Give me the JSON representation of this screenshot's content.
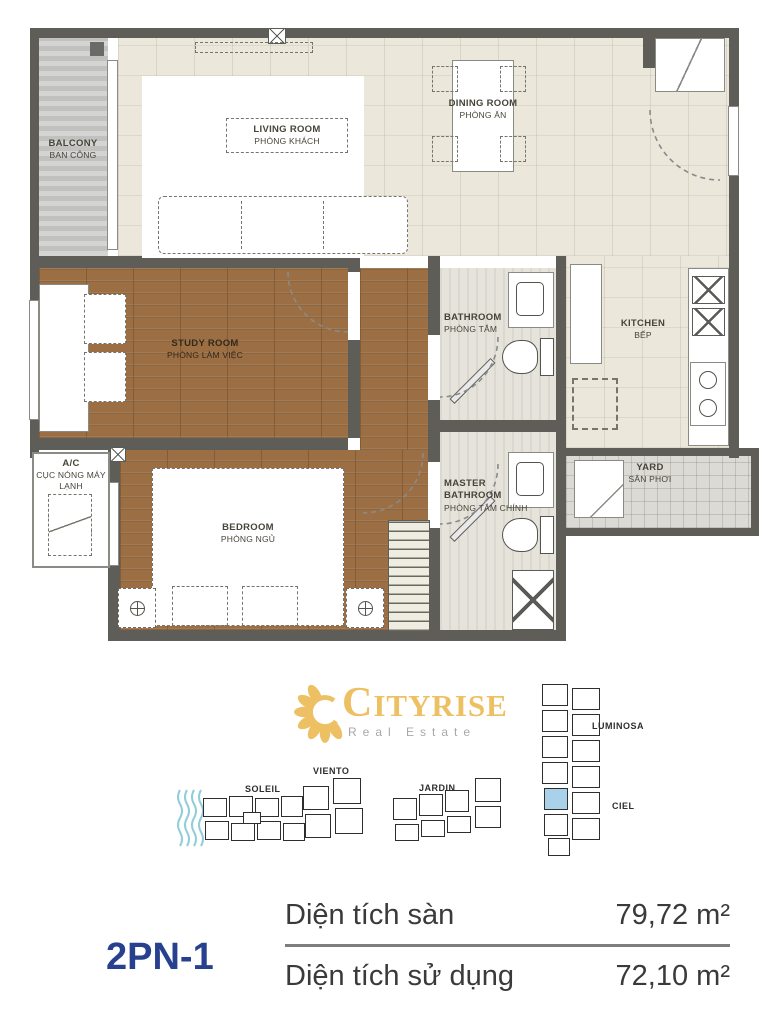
{
  "plan": {
    "rooms": {
      "balcony": {
        "en": "BALCONY",
        "vi": "BAN CÔNG"
      },
      "living_room": {
        "en": "LIVING ROOM",
        "vi": "PHÒNG KHÁCH"
      },
      "dining_room": {
        "en": "DINING ROOM",
        "vi": "PHÒNG ĂN"
      },
      "study_room": {
        "en": "STUDY ROOM",
        "vi": "PHÒNG LÀM VIỆC"
      },
      "bathroom": {
        "en": "BATHROOM",
        "vi": "PHÒNG TẮM"
      },
      "kitchen": {
        "en": "KITCHEN",
        "vi": "BẾP"
      },
      "master_bathroom": {
        "en": "MASTER BATHROOM",
        "vi": "PHÒNG TẮM CHÍNH"
      },
      "bedroom": {
        "en": "BEDROOM",
        "vi": "PHÒNG NGỦ"
      },
      "yard": {
        "en": "YARD",
        "vi": "SÂN PHƠI"
      },
      "ac_unit": {
        "en": "A/C",
        "vi": "CỤC NÓNG MÁY LẠNH"
      }
    }
  },
  "logo": {
    "wordmark": "CITYRISE",
    "tagline": "Real Estate"
  },
  "siteplan": {
    "buildings": [
      "SOLEIL",
      "VIENTO",
      "JARDIN",
      "LUMINOSA",
      "CIEL"
    ]
  },
  "unit": {
    "code": "2PN-1",
    "specs": [
      {
        "label": "Diện tích sàn",
        "value": "79,72 m²"
      },
      {
        "label": "Diện tích sử dụng",
        "value": "72,10 m²"
      }
    ]
  },
  "colors": {
    "unit_code_blue": "#28418f",
    "logo_gold": "#eec064",
    "highlighted_unit": "#a9d2ea",
    "wave_blue": "#8fcdd8",
    "wall_gray": "#5e5d58"
  }
}
